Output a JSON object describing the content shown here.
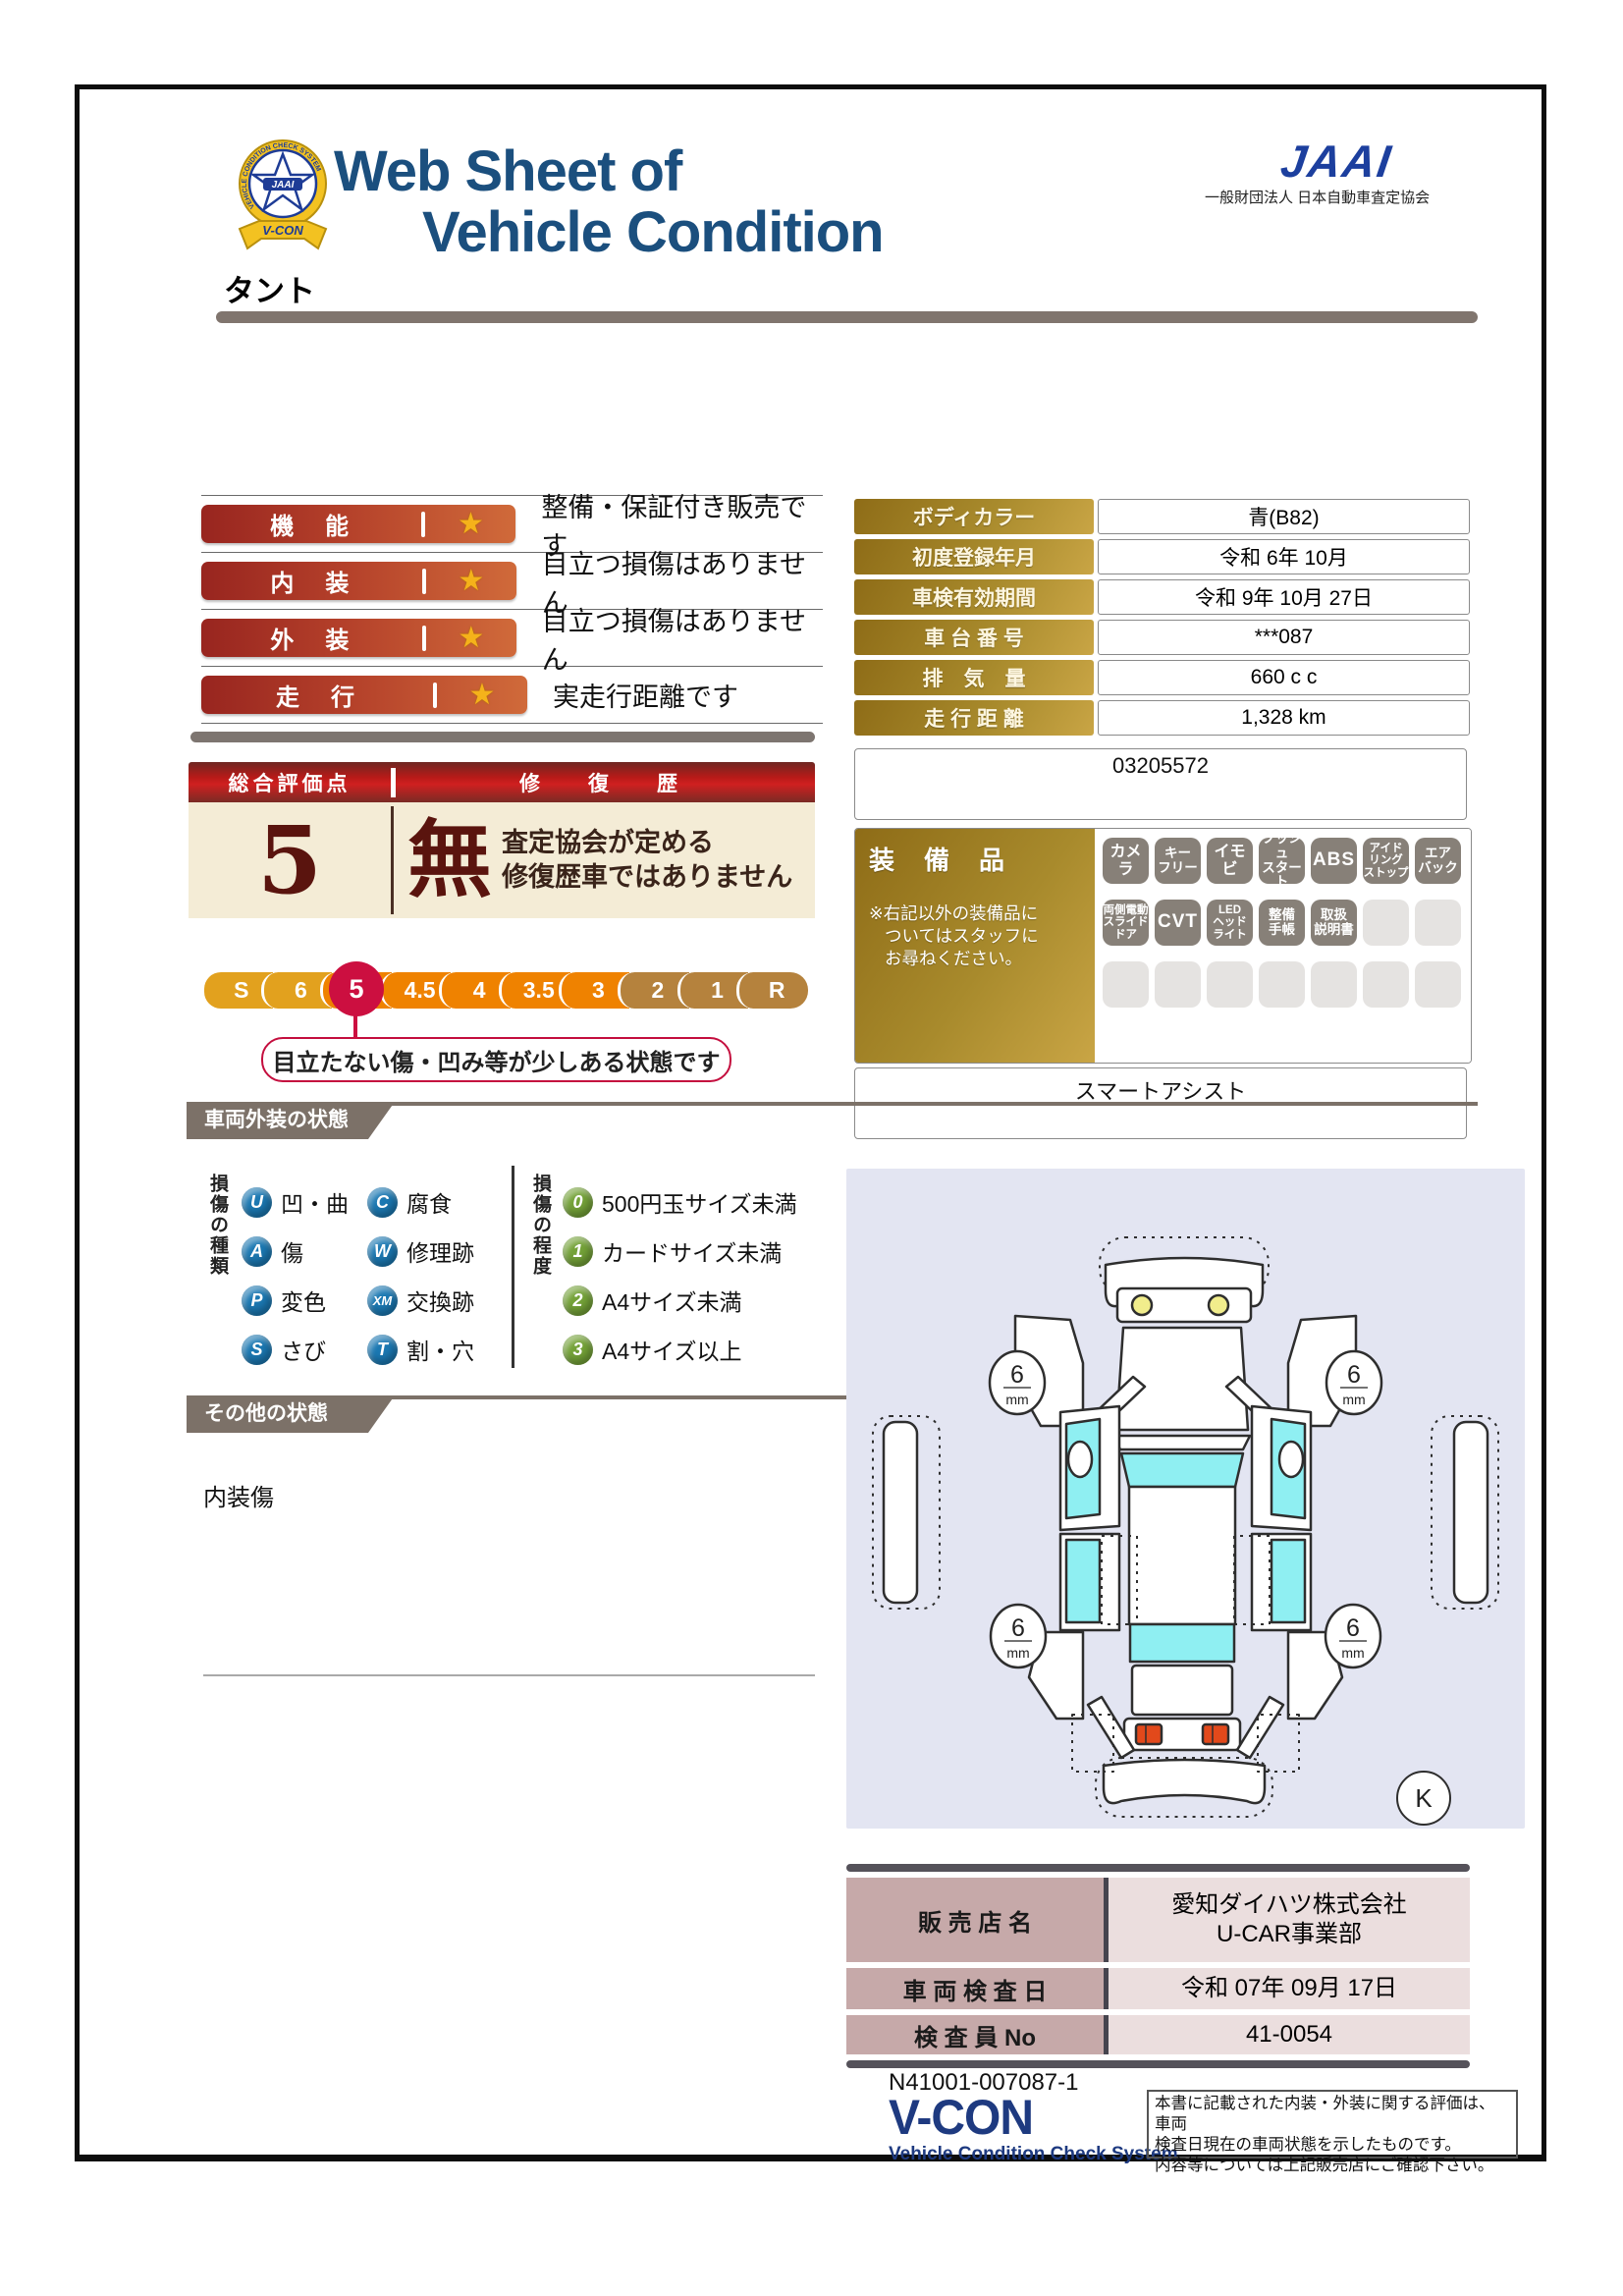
{
  "header": {
    "title_line1": "Web Sheet of",
    "title_line2": "Vehicle Condition",
    "jaai_logo_text": "JAAI",
    "jaai_org_name": "一般財団法人 日本自動車査定協会",
    "badge_ring_text": "VEHICLE CONDITION CHECK SYSTEM",
    "badge_ribbon_text": "V-CON",
    "badge_center_text": "JAAI",
    "vehicle_name": "タント"
  },
  "ratings": [
    {
      "label": "機　能",
      "star": "★",
      "desc": "整備・保証付き販売です"
    },
    {
      "label": "内　装",
      "star": "★",
      "desc": "目立つ損傷はありません"
    },
    {
      "label": "外　装",
      "star": "★",
      "desc": "目立つ損傷はありません"
    },
    {
      "label": "走　行",
      "star": "★",
      "desc": "実走行距離です"
    }
  ],
  "spec_table": {
    "rows": [
      {
        "label": "ボディカラー",
        "value": "青(B82)"
      },
      {
        "label": "初度登録年月",
        "value": "令和 6年 10月"
      },
      {
        "label": "車検有効期間",
        "value": "令和 9年 10月 27日"
      },
      {
        "label": "車 台 番 号",
        "value": "***087"
      },
      {
        "label": "排　気　量",
        "value": "660 c c"
      },
      {
        "label": "走 行 距 離",
        "value": "1,328 km"
      }
    ],
    "ref_number": "03205572"
  },
  "overall": {
    "header_left": "総合評価点",
    "header_right": "修　復　歴",
    "score": "5",
    "repair_flag": "無",
    "repair_note_line1": "査定協会が定める",
    "repair_note_line2": "修復歴車ではありません"
  },
  "scale": {
    "segments": [
      {
        "label": "S",
        "color": "#e2a11e"
      },
      {
        "label": "6",
        "color": "#e2a11e"
      },
      {
        "label": "5",
        "color": "#ef8200"
      },
      {
        "label": "4.5",
        "color": "#ef8200"
      },
      {
        "label": "4",
        "color": "#ef8200"
      },
      {
        "label": "3.5",
        "color": "#ef8200"
      },
      {
        "label": "3",
        "color": "#ef8200"
      },
      {
        "label": "2",
        "color": "#b5823d"
      },
      {
        "label": "1",
        "color": "#b5823d"
      },
      {
        "label": "R",
        "color": "#b5823d"
      }
    ],
    "selected_label": "5",
    "selected_color": "#cc0f40",
    "callout_text": "目立たない傷・凹み等が少しある状態です"
  },
  "equipment": {
    "section_label": "装　備　品",
    "note_line1": "※右記以外の装備品に",
    "note_line2": "ついてはスタッフに",
    "note_line3": "お尋ねください。",
    "items": [
      "カメラ",
      "キー\nフリー",
      "イモビ",
      "プッシュ\nスタート",
      "ABS",
      "アイド\nリング\nストップ",
      "エア\nバック",
      "両側電動\nスライド\nドア",
      "CVT",
      "LED\nヘッド\nライト",
      "整備\n手帳",
      "取扱\n説明書"
    ],
    "extra_feature": "スマートアシスト"
  },
  "exterior_section": {
    "title": "車両外装の状態",
    "kind_header": "損傷の種類",
    "kind_color": "#1b78b2",
    "kinds": [
      {
        "code": "U",
        "label": "凹・曲"
      },
      {
        "code": "C",
        "label": "腐食"
      },
      {
        "code": "A",
        "label": "傷"
      },
      {
        "code": "W",
        "label": "修理跡"
      },
      {
        "code": "P",
        "label": "変色"
      },
      {
        "code": "XM",
        "label": "交換跡"
      },
      {
        "code": "S",
        "label": "さび"
      },
      {
        "code": "T",
        "label": "割・穴"
      }
    ],
    "degree_header": "損傷の程度",
    "degree_color": "#74a238",
    "degrees": [
      {
        "code": "0",
        "label": "500円玉サイズ未満"
      },
      {
        "code": "1",
        "label": "カードサイズ未満"
      },
      {
        "code": "2",
        "label": "A4サイズ未満"
      },
      {
        "code": "3",
        "label": "A4サイズ以上"
      }
    ]
  },
  "other_section": {
    "title": "その他の状態",
    "note": "内装傷"
  },
  "diagram": {
    "tire_tread_value": "6",
    "tire_tread_unit": "mm",
    "corner_marker": "K"
  },
  "dealer_table": {
    "rows": [
      {
        "label": "販 売 店 名",
        "value_line1": "愛知ダイハツ株式会社",
        "value_line2": "U-CAR事業部"
      },
      {
        "label": "車 両 検 査 日",
        "value_line1": "令和 07年 09月 17日",
        "value_line2": ""
      },
      {
        "label": "検 査 員 No",
        "value_line1": "41-0054",
        "value_line2": ""
      }
    ]
  },
  "footer": {
    "doc_number": "N41001-007087-1",
    "vcon_logo": "V-CON",
    "vcon_subtitle": "Vehicle Condition Check System",
    "disclaimer_line1": "本書に記載された内装・外装に関する評価は、車両",
    "disclaimer_line2": "検査日現在の車両状態を示したものです。",
    "disclaimer_line3": "内容等については上記販売店にご確認下さい。"
  }
}
